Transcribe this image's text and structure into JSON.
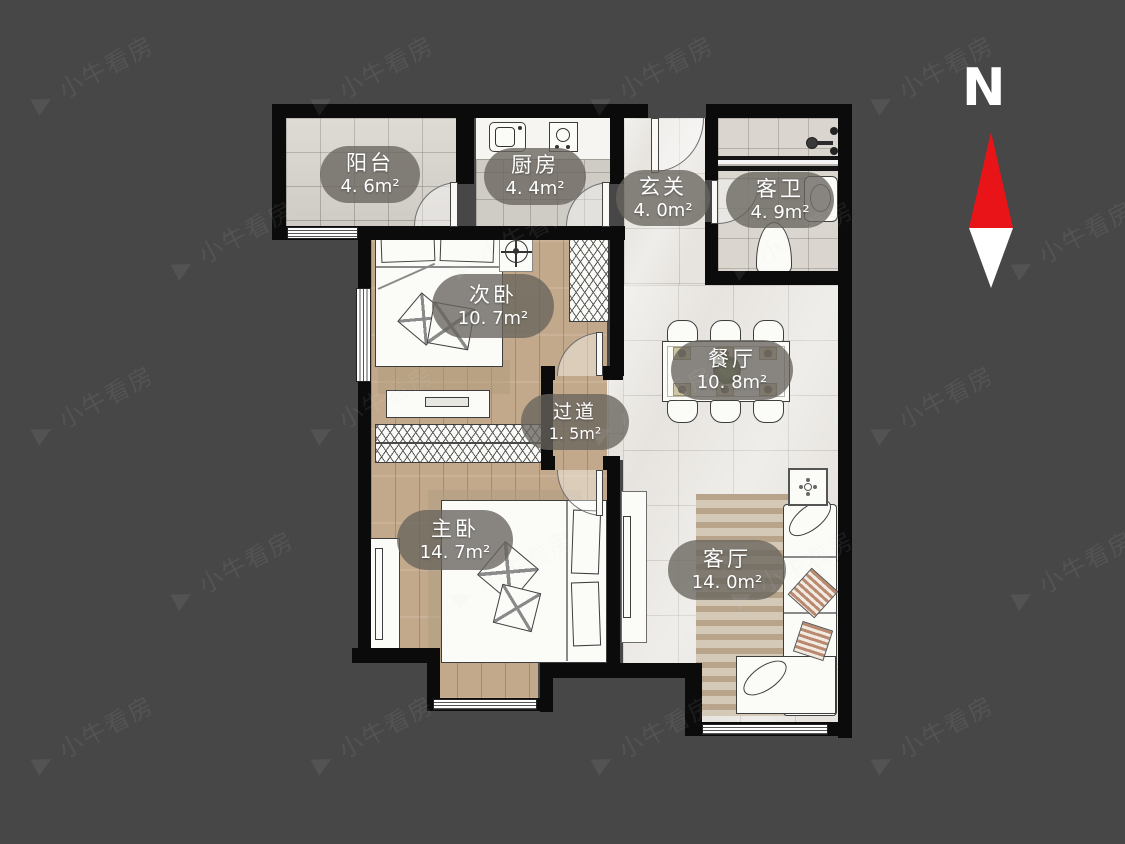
{
  "compass": {
    "label": "N",
    "north_color": "#e81418",
    "south_color": "#ffffff"
  },
  "watermark": {
    "icon": "▶",
    "text": "小牛看房"
  },
  "colors": {
    "background": "#474747",
    "wall": "#0b0b0b",
    "label_pill": "rgba(104,100,94,0.78)"
  },
  "rooms": [
    {
      "id": "balcony",
      "name": "阳台",
      "area": "4. 6m²"
    },
    {
      "id": "kitchen",
      "name": "厨房",
      "area": "4. 4m²"
    },
    {
      "id": "entry",
      "name": "玄关",
      "area": "4. 0m²"
    },
    {
      "id": "bath",
      "name": "客卫",
      "area": "4. 9m²"
    },
    {
      "id": "bedroom2",
      "name": "次卧",
      "area": "10. 7m²"
    },
    {
      "id": "hallway",
      "name": "过道",
      "area": "1. 5m²"
    },
    {
      "id": "dining",
      "name": "餐厅",
      "area": "10. 8m²"
    },
    {
      "id": "master",
      "name": "主卧",
      "area": "14. 7m²"
    },
    {
      "id": "living",
      "name": "客厅",
      "area": "14. 0m²"
    }
  ]
}
